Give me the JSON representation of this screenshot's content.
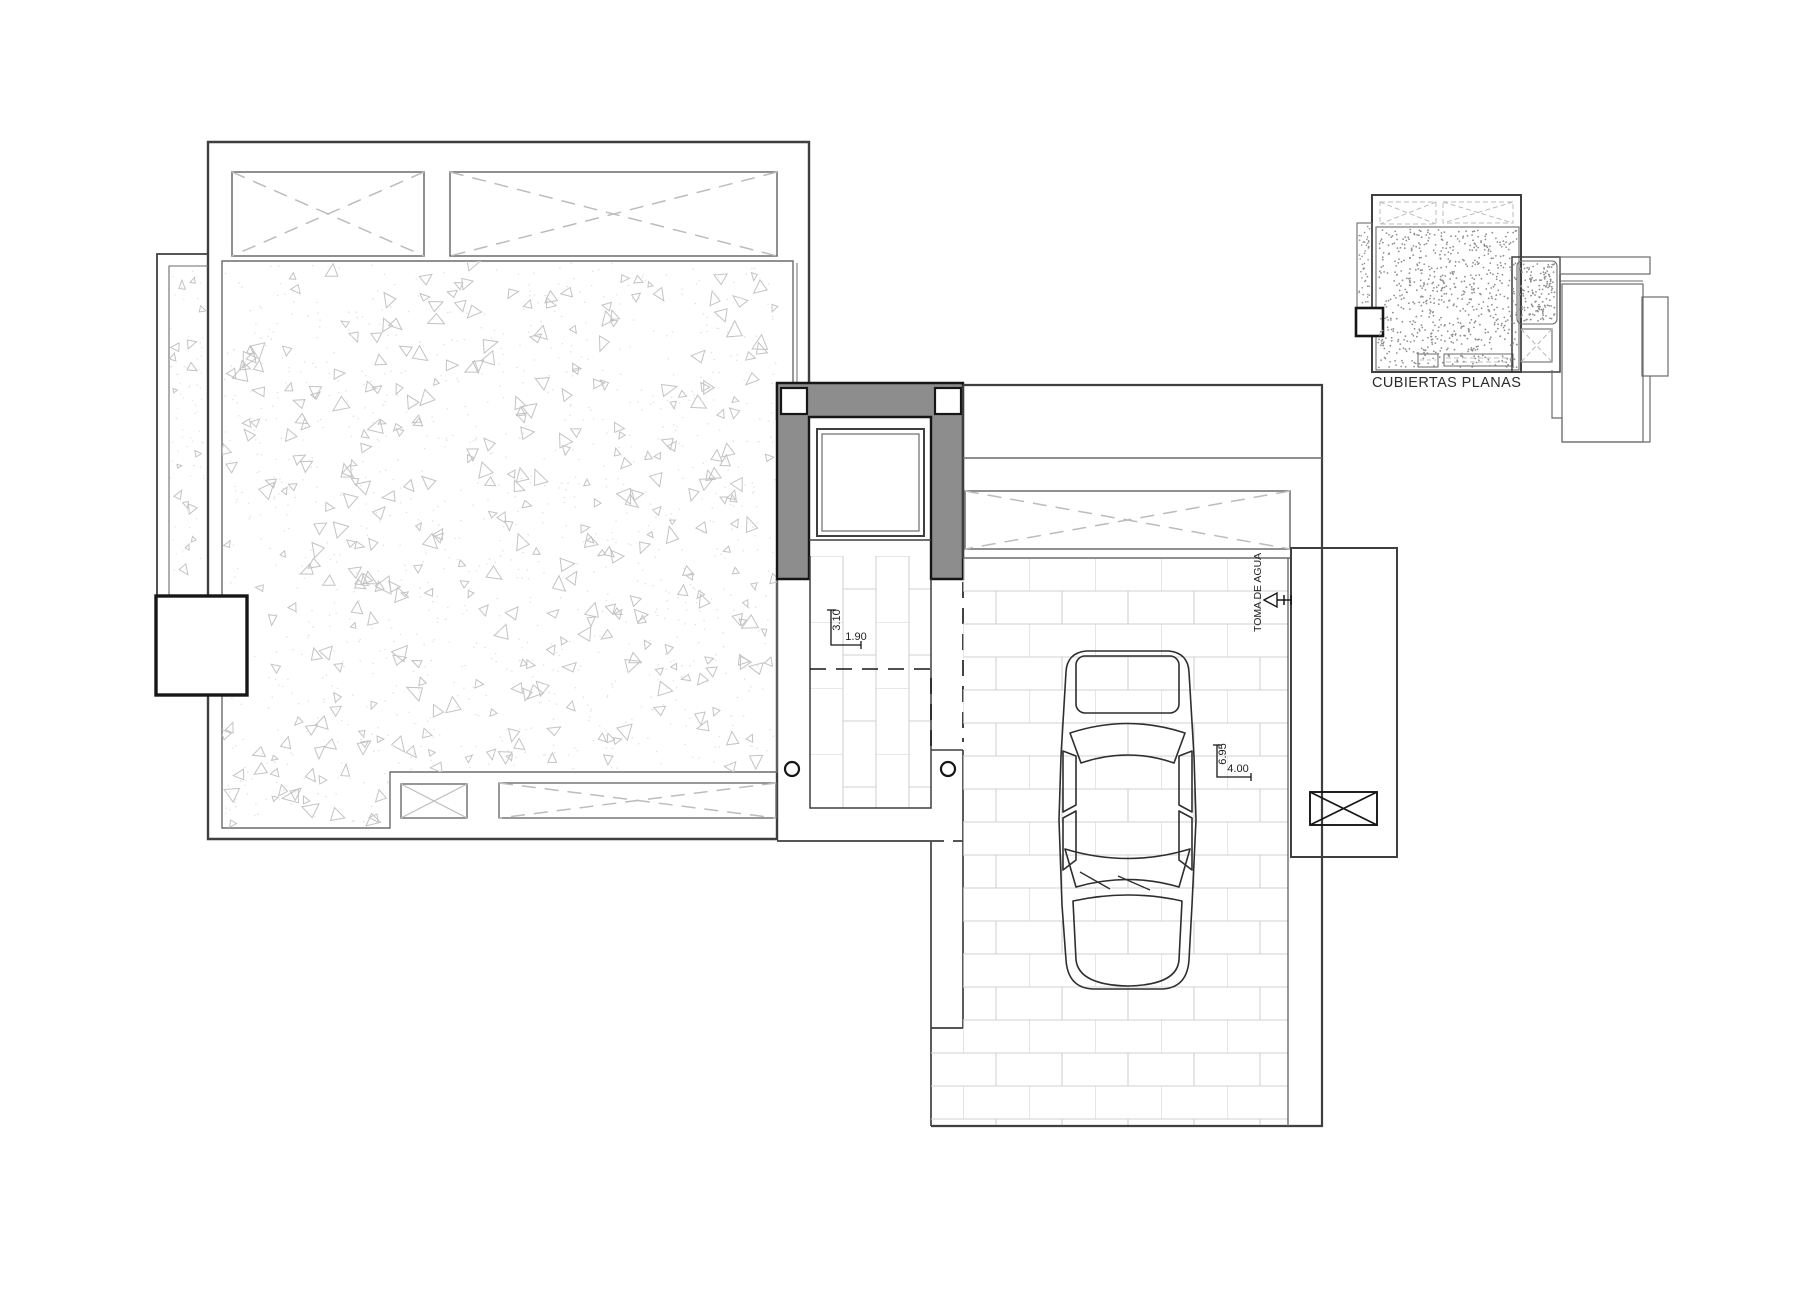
{
  "drawing": {
    "key_plan_label": "CUBIERTAS PLANAS",
    "water_intake_label": "TOMA DE AGUA",
    "dimensions": {
      "corridor_length": "3.10",
      "corridor_width": "1.90",
      "garage_length": "6.95",
      "garage_width": "4.00"
    }
  },
  "colors": {
    "line": "#3f3f3f",
    "thin": "#6b6b6b",
    "dark": "#161616",
    "dash": "#bcbcbc",
    "wall_fill": "#8d8d8d",
    "brick_joint": "#d0d0d0",
    "stipple": "#c3c3c3",
    "stipple_dot": "#e3e3e3",
    "miniplan_dot": "#8f8f8f",
    "background": "#ffffff"
  }
}
